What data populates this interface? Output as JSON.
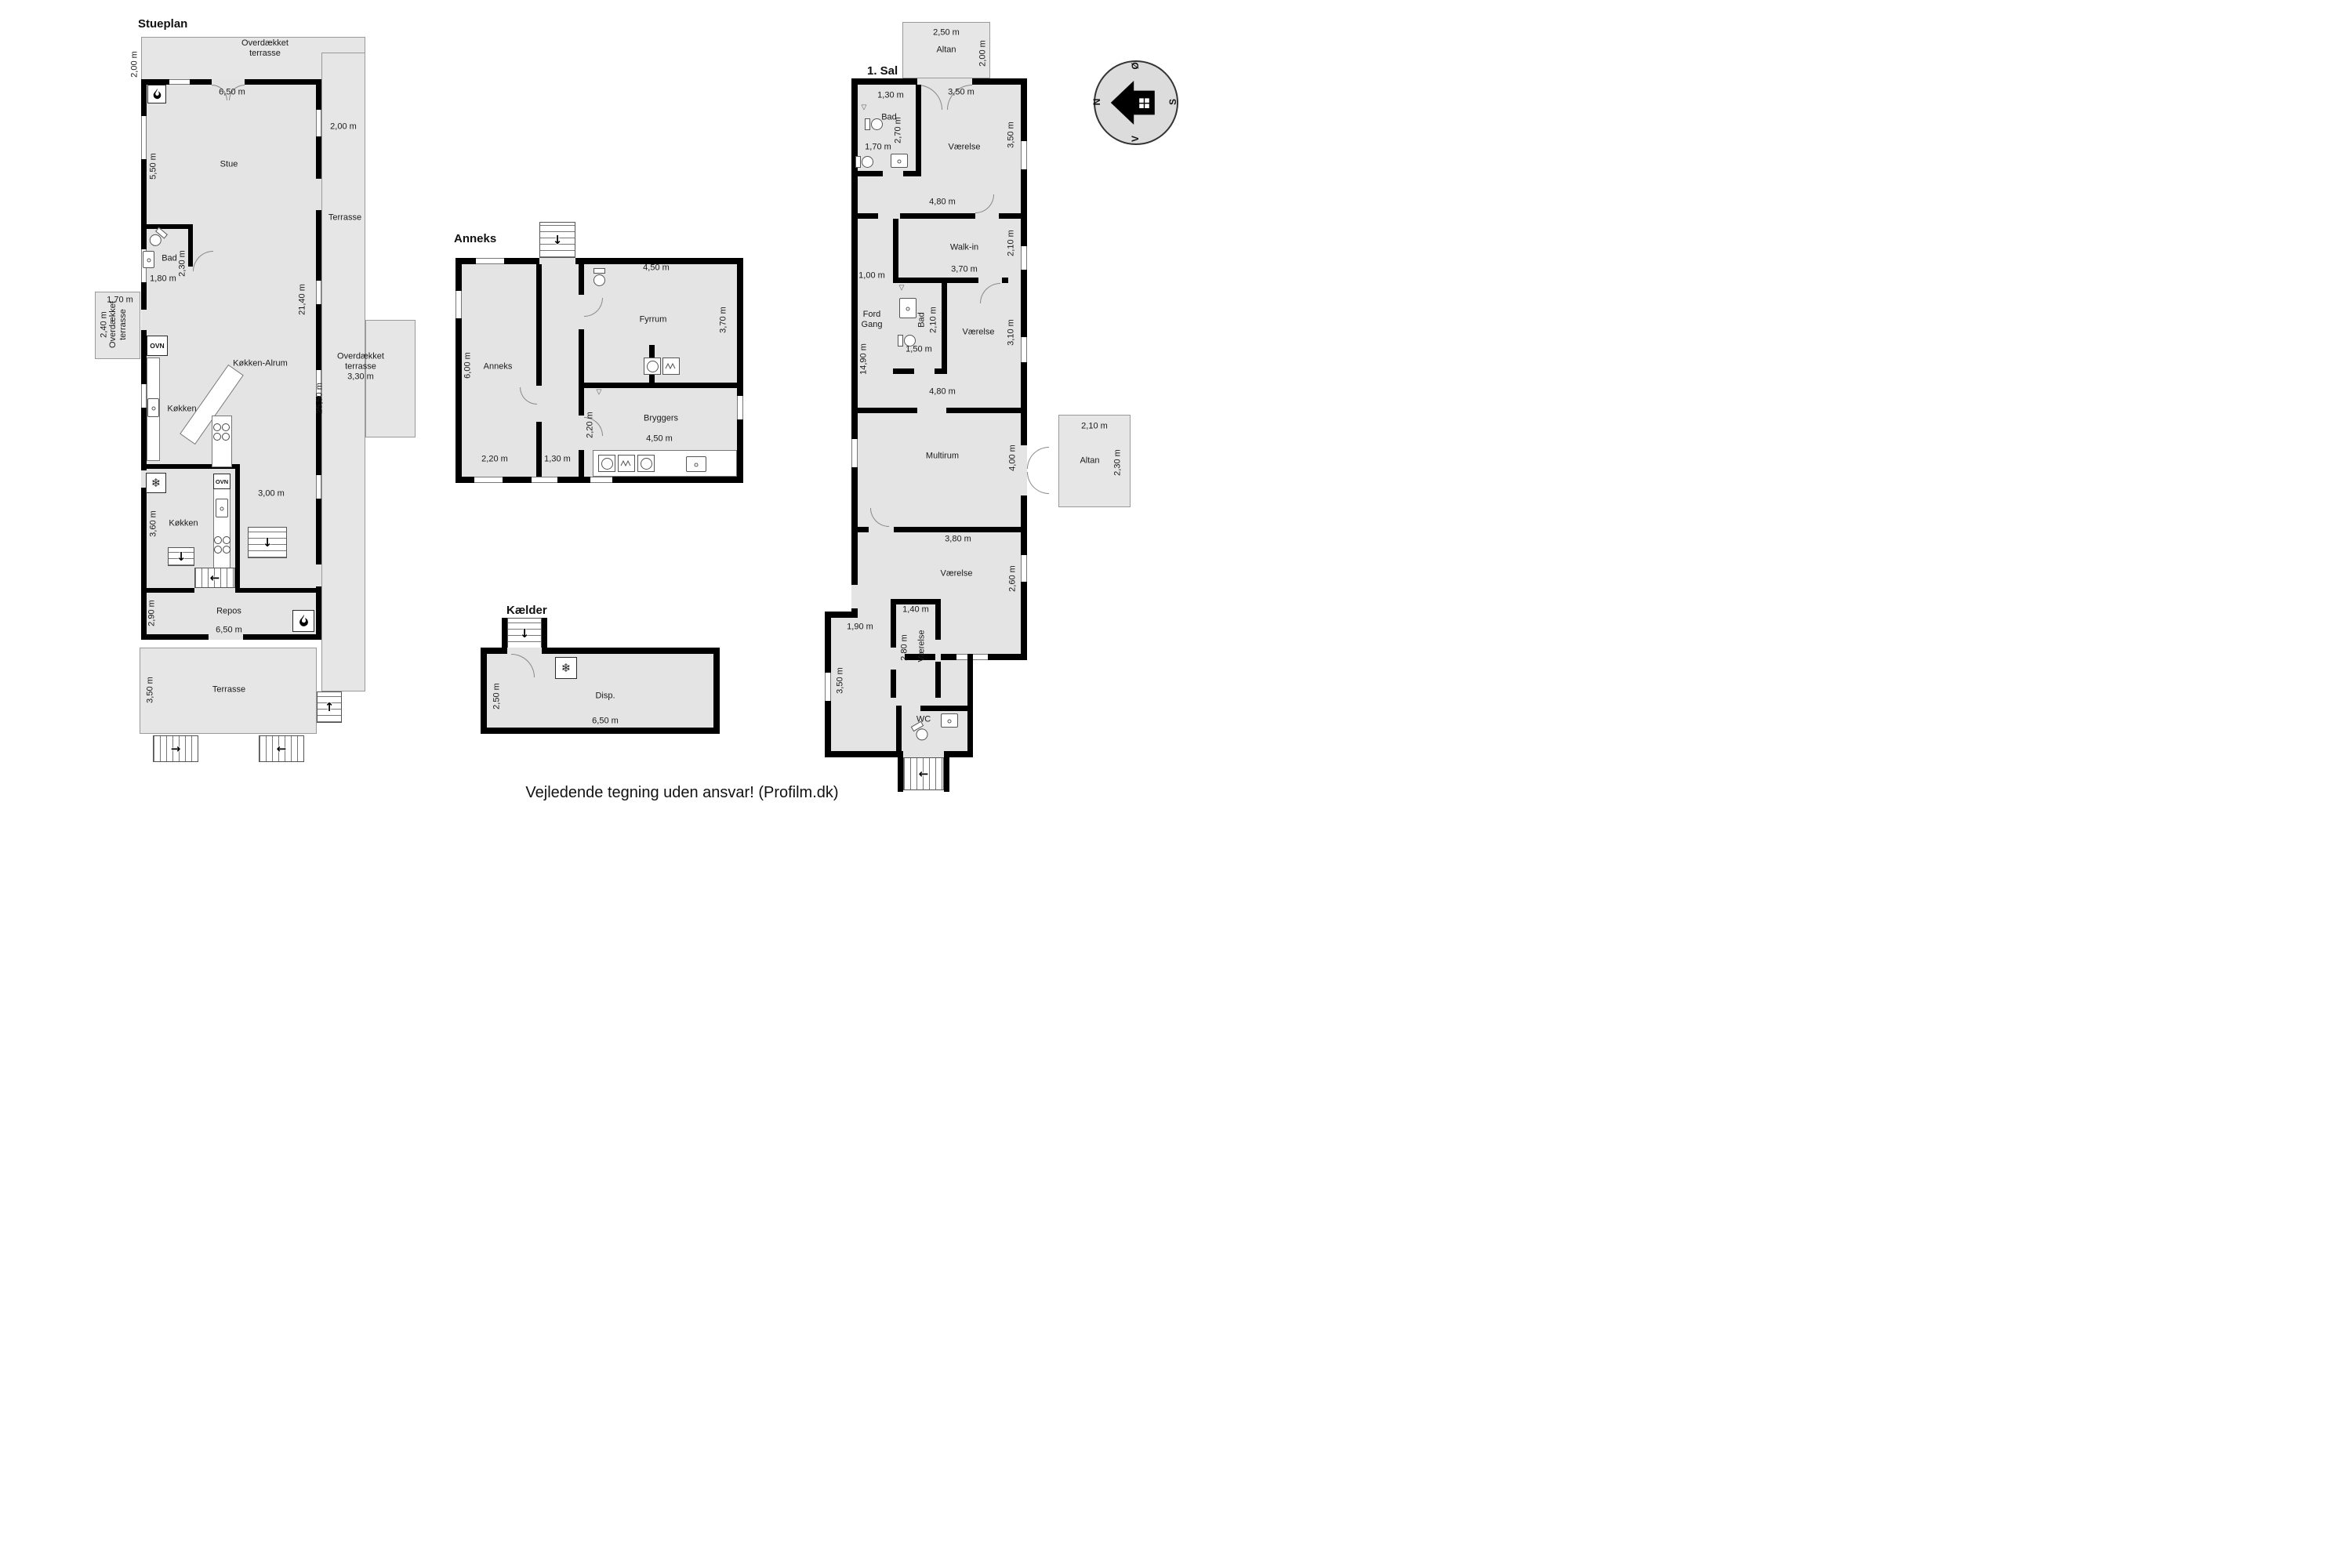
{
  "caption": "Vejledende tegning uden ansvar! (Profilm.dk)",
  "icons": {
    "arrow_up": "↑",
    "arrow_down": "↓",
    "arrow_left": "←",
    "arrow_right": "→",
    "snowflake": "❄",
    "shower_symbol": "▽"
  },
  "compass": {
    "n": "N",
    "oe": "Ø",
    "s": "S",
    "v": "V"
  },
  "stueplan": {
    "title": "Stueplan",
    "dim_top_height": "2,00 m",
    "overdaekket_top": "Overdækket\nterrasse",
    "dim_stue_width": "6,50 m",
    "stue": "Stue",
    "dim_stue_height": "5,50 m",
    "dim_terrasse_right_width": "2,00 m",
    "terrasse_right": "Terrasse",
    "bad": "Bad",
    "dim_bad_height": "2,30 m",
    "dim_bad_width": "1,80 m",
    "dim_deck_left_width": "1,70 m",
    "dim_deck_left_height": "2,40 m",
    "overdaekket_left": "Overdækket\nterrasse",
    "dim_alrum_height": "21,40 m",
    "ovn_top": "OVN",
    "koekken_alrum": "Køkken-Alrum",
    "overdaekket_right": "Overdækket\nterrasse\n3,30 m",
    "koekken_top": "Køkken",
    "dim_total_height": "25,50 m",
    "ovn_bottom": "OVN",
    "dim_koekken_width": "3,00 m",
    "koekken_bottom": "Køkken",
    "dim_koekken_height": "3,60 m",
    "dim_repos_height": "2,90 m",
    "repos": "Repos",
    "dim_repos_width": "6,50 m",
    "dim_terrasse_height": "3,50 m",
    "terrasse_bottom": "Terrasse"
  },
  "anneks": {
    "title": "Anneks",
    "dim_fyrrum_width": "4,50 m",
    "fyrrum": "Fyrrum",
    "dim_fyrrum_height": "3,70 m",
    "dim_anneks_height": "6,00 m",
    "anneks_room": "Anneks",
    "dim_bryggers_height": "2,20 m",
    "bryggers": "Bryggers",
    "dim_bryggers_width": "4,50 m",
    "dim_anneks_width": "2,20 m",
    "dim_gang_width": "1,30 m"
  },
  "kaelder": {
    "title": "Kælder",
    "dim_height": "2,50 m",
    "disp": "Disp.",
    "dim_width": "6,50 m"
  },
  "sal": {
    "title": "1. Sal",
    "altan_top": {
      "dim_width": "2,50 m",
      "name": "Altan",
      "dim_height": "2,00 m"
    },
    "bad_top": {
      "dim_width": "1,30 m",
      "name": "Bad",
      "dim_height": "2,70 m",
      "dim_inner": "1,70 m"
    },
    "vaerelse_top": {
      "dim_width": "3,50 m",
      "name": "Værelse",
      "dim_height": "3,50 m"
    },
    "dim_gang_top": "4,80 m",
    "walkin": {
      "name": "Walk-in",
      "dim_height": "2,10 m",
      "dim_width": "3,70 m"
    },
    "dim_gang_width": "1,00 m",
    "fordgang": "Ford\nGang",
    "bad_mid": {
      "name": "Bad",
      "dim_height": "2,10 m",
      "dim_width": "1,50 m"
    },
    "vaerelse_mid": {
      "name": "Værelse",
      "dim_height": "3,10 m"
    },
    "dim_total_height": "14,90 m",
    "dim_gang_bottom": "4,80 m",
    "multirum": {
      "name": "Multirum",
      "dim_height": "4,00 m"
    },
    "altan_right": {
      "dim_width": "2,10 m",
      "name": "Altan",
      "dim_height": "2,30 m"
    },
    "vaerelse_bottom": {
      "dim_width": "3,80 m",
      "name": "Værelse",
      "dim_height": "2,60 m"
    },
    "vaerelse_small": {
      "dim_width": "1,40 m",
      "dim_height": "2,80 m",
      "name": "Værelse"
    },
    "dim_entry": "1,90 m",
    "dim_wing_height": "3,50 m",
    "wc": "WC"
  }
}
